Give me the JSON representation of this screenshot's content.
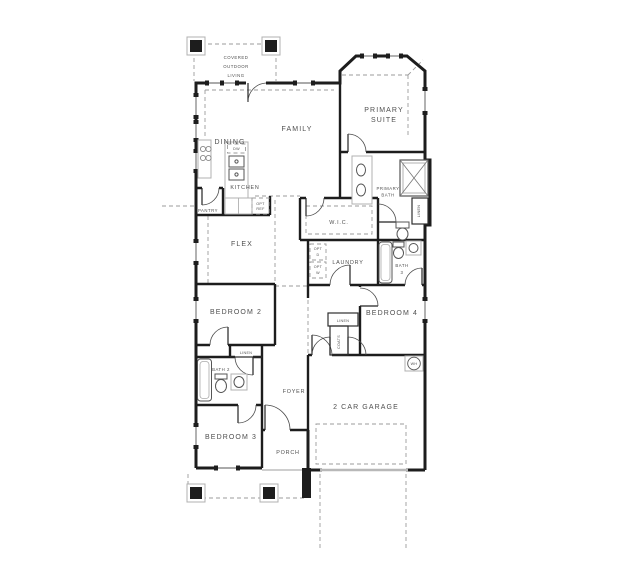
{
  "colors": {
    "wall": "#1d1d1d",
    "fixture_gray": "#b0b0b0",
    "dashed_line": "#9b9b9b",
    "label_text": "#4f4f4f",
    "garage_door": "#b8b8b8",
    "background": "#ffffff"
  },
  "labels": {
    "covered_outdoor_living": {
      "line1": "COVERED",
      "line2": "OUTDOOR",
      "line3": "LIVING"
    },
    "dining": "DINING",
    "family": "FAMILY",
    "primary_suite": {
      "line1": "PRIMARY",
      "line2": "SUITE"
    },
    "kitchen": "KITCHEN",
    "pantry": "PANTRY",
    "opt_ref": {
      "line1": "OPT",
      "line2": "REF"
    },
    "dishwasher": "DW",
    "flex": "FLEX",
    "wic": "W.I.C.",
    "primary_bath": {
      "line1": "PRIMARY",
      "line2": "BATH"
    },
    "linen_primary": "LINEN",
    "laundry": "LAUNDRY",
    "opt_dryer": {
      "line1": "OPT",
      "line2": "D"
    },
    "opt_washer": {
      "line1": "OPT",
      "line2": "W"
    },
    "bath3": {
      "line1": "BATH",
      "line2": "3"
    },
    "bedroom2": "BEDROOM 2",
    "bedroom4": "BEDROOM 4",
    "linen_hall": "LINEN",
    "coats": "COATS",
    "linen_bath2": "LINEN",
    "bath2": "BATH 2",
    "foyer": "FOYER",
    "bedroom3": "BEDROOM 3",
    "porch": "PORCH",
    "garage": "2 CAR GARAGE",
    "water_heater": "WH"
  }
}
